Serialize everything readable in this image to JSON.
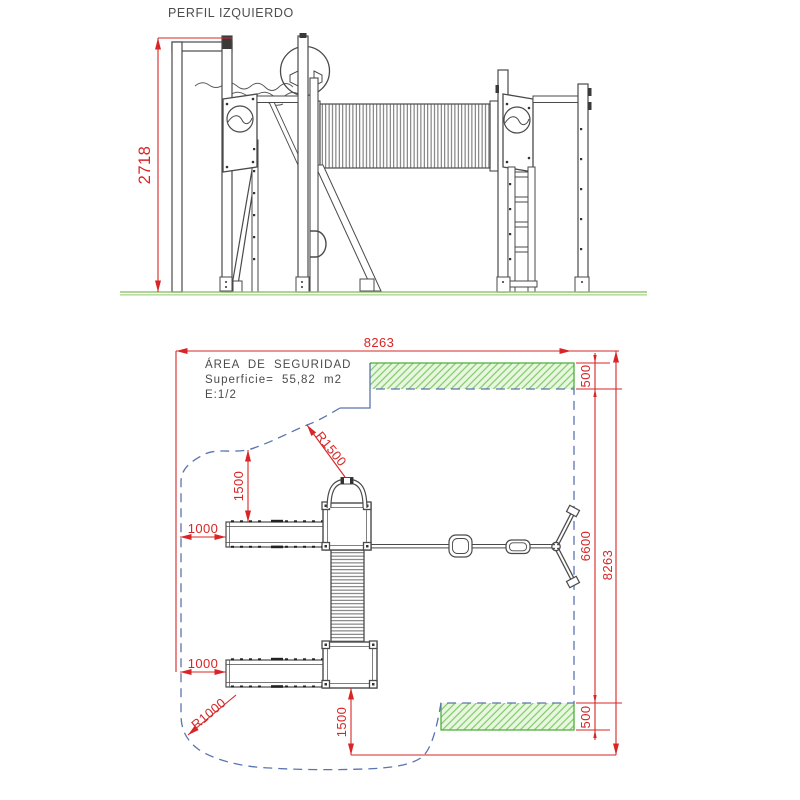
{
  "title": "PERFIL IZQUIERDO",
  "colors": {
    "dimension_red": "#d92525",
    "boundary_blue": "#5b74ae",
    "safety_green": "#4fae3e",
    "hatch_green": "#7ecb66",
    "drawing_gray": "#4a4a4a",
    "ground_green": "#7fba55"
  },
  "elevation": {
    "height_dim": "2718"
  },
  "plan": {
    "safety_area": {
      "title": "ÁREA DE SEGURIDAD",
      "surface": "Superficie= 55,82 m2",
      "scale": "E:1/2"
    },
    "dimensions": {
      "total_width": "8263",
      "total_height": "8263",
      "inner_height": "6600",
      "top_strip": "500",
      "bottom_strip": "500",
      "top_clearance": "1500",
      "bottom_clearance": "1500",
      "left_offset_top": "1000",
      "left_offset_bottom": "1000",
      "radius_top": "R1500",
      "radius_bottom": "R1000"
    }
  }
}
